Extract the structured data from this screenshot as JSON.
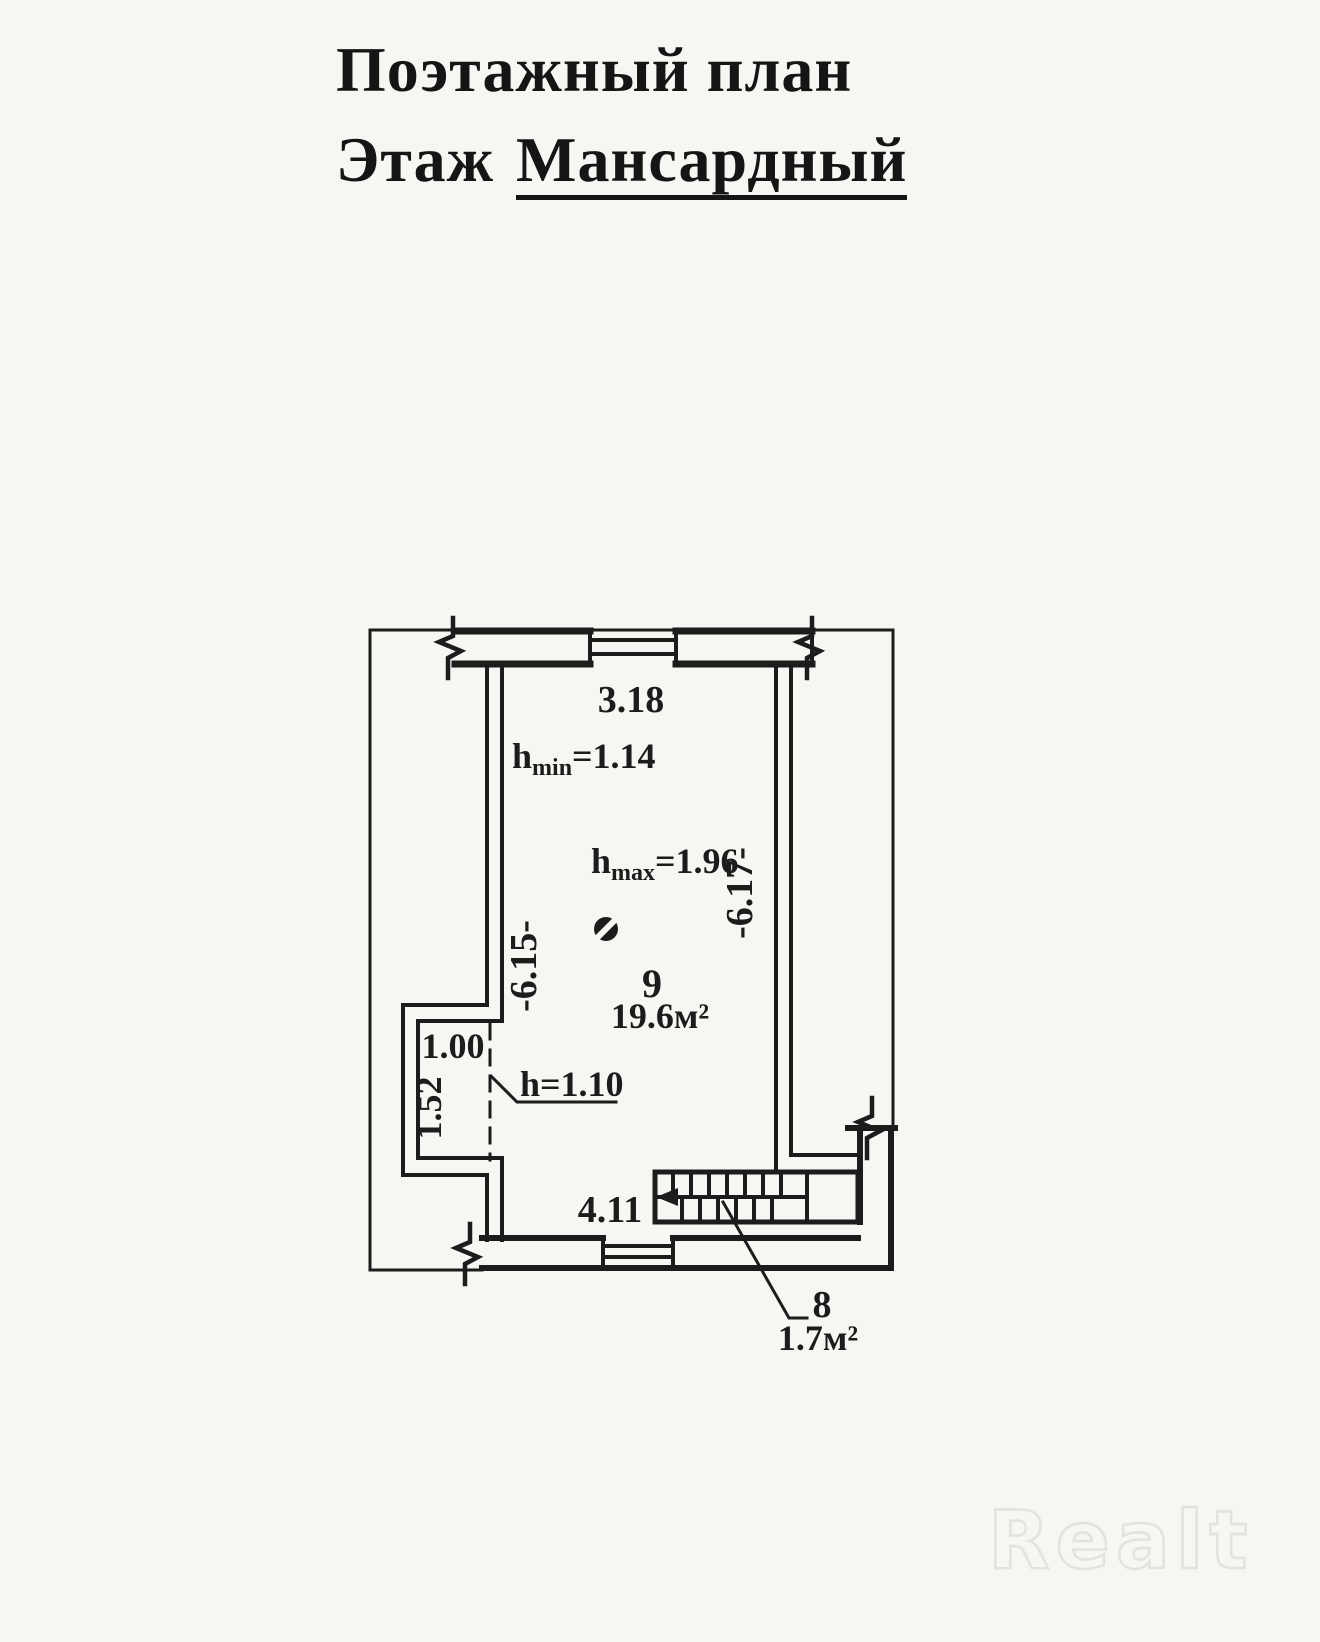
{
  "colors": {
    "paper": "#f6f6f3",
    "ink": "#1c1c1c",
    "watermark_outline": "#e2e2df"
  },
  "header": {
    "line1": "Поэтажный план",
    "line2_prefix": "Этаж",
    "line2_value": "Мансардный"
  },
  "plan": {
    "dim_top_width": "3.18",
    "h_min": {
      "base": "h",
      "sub": "min",
      "eq": "=1.14"
    },
    "h_max": {
      "base": "h",
      "sub": "max",
      "eq": "=1.96"
    },
    "dim_right_length": "-6.17-",
    "dim_left_length": "-6.15-",
    "alcove_width": "1.00",
    "alcove_depth": "1.52",
    "h_low_zone": "h=1.10",
    "dim_bottom_width": "4.11",
    "rooms": [
      {
        "number": "9",
        "area": "19.6м²"
      },
      {
        "number": "8",
        "area": "1.7м²"
      }
    ]
  },
  "watermark": "Realt"
}
